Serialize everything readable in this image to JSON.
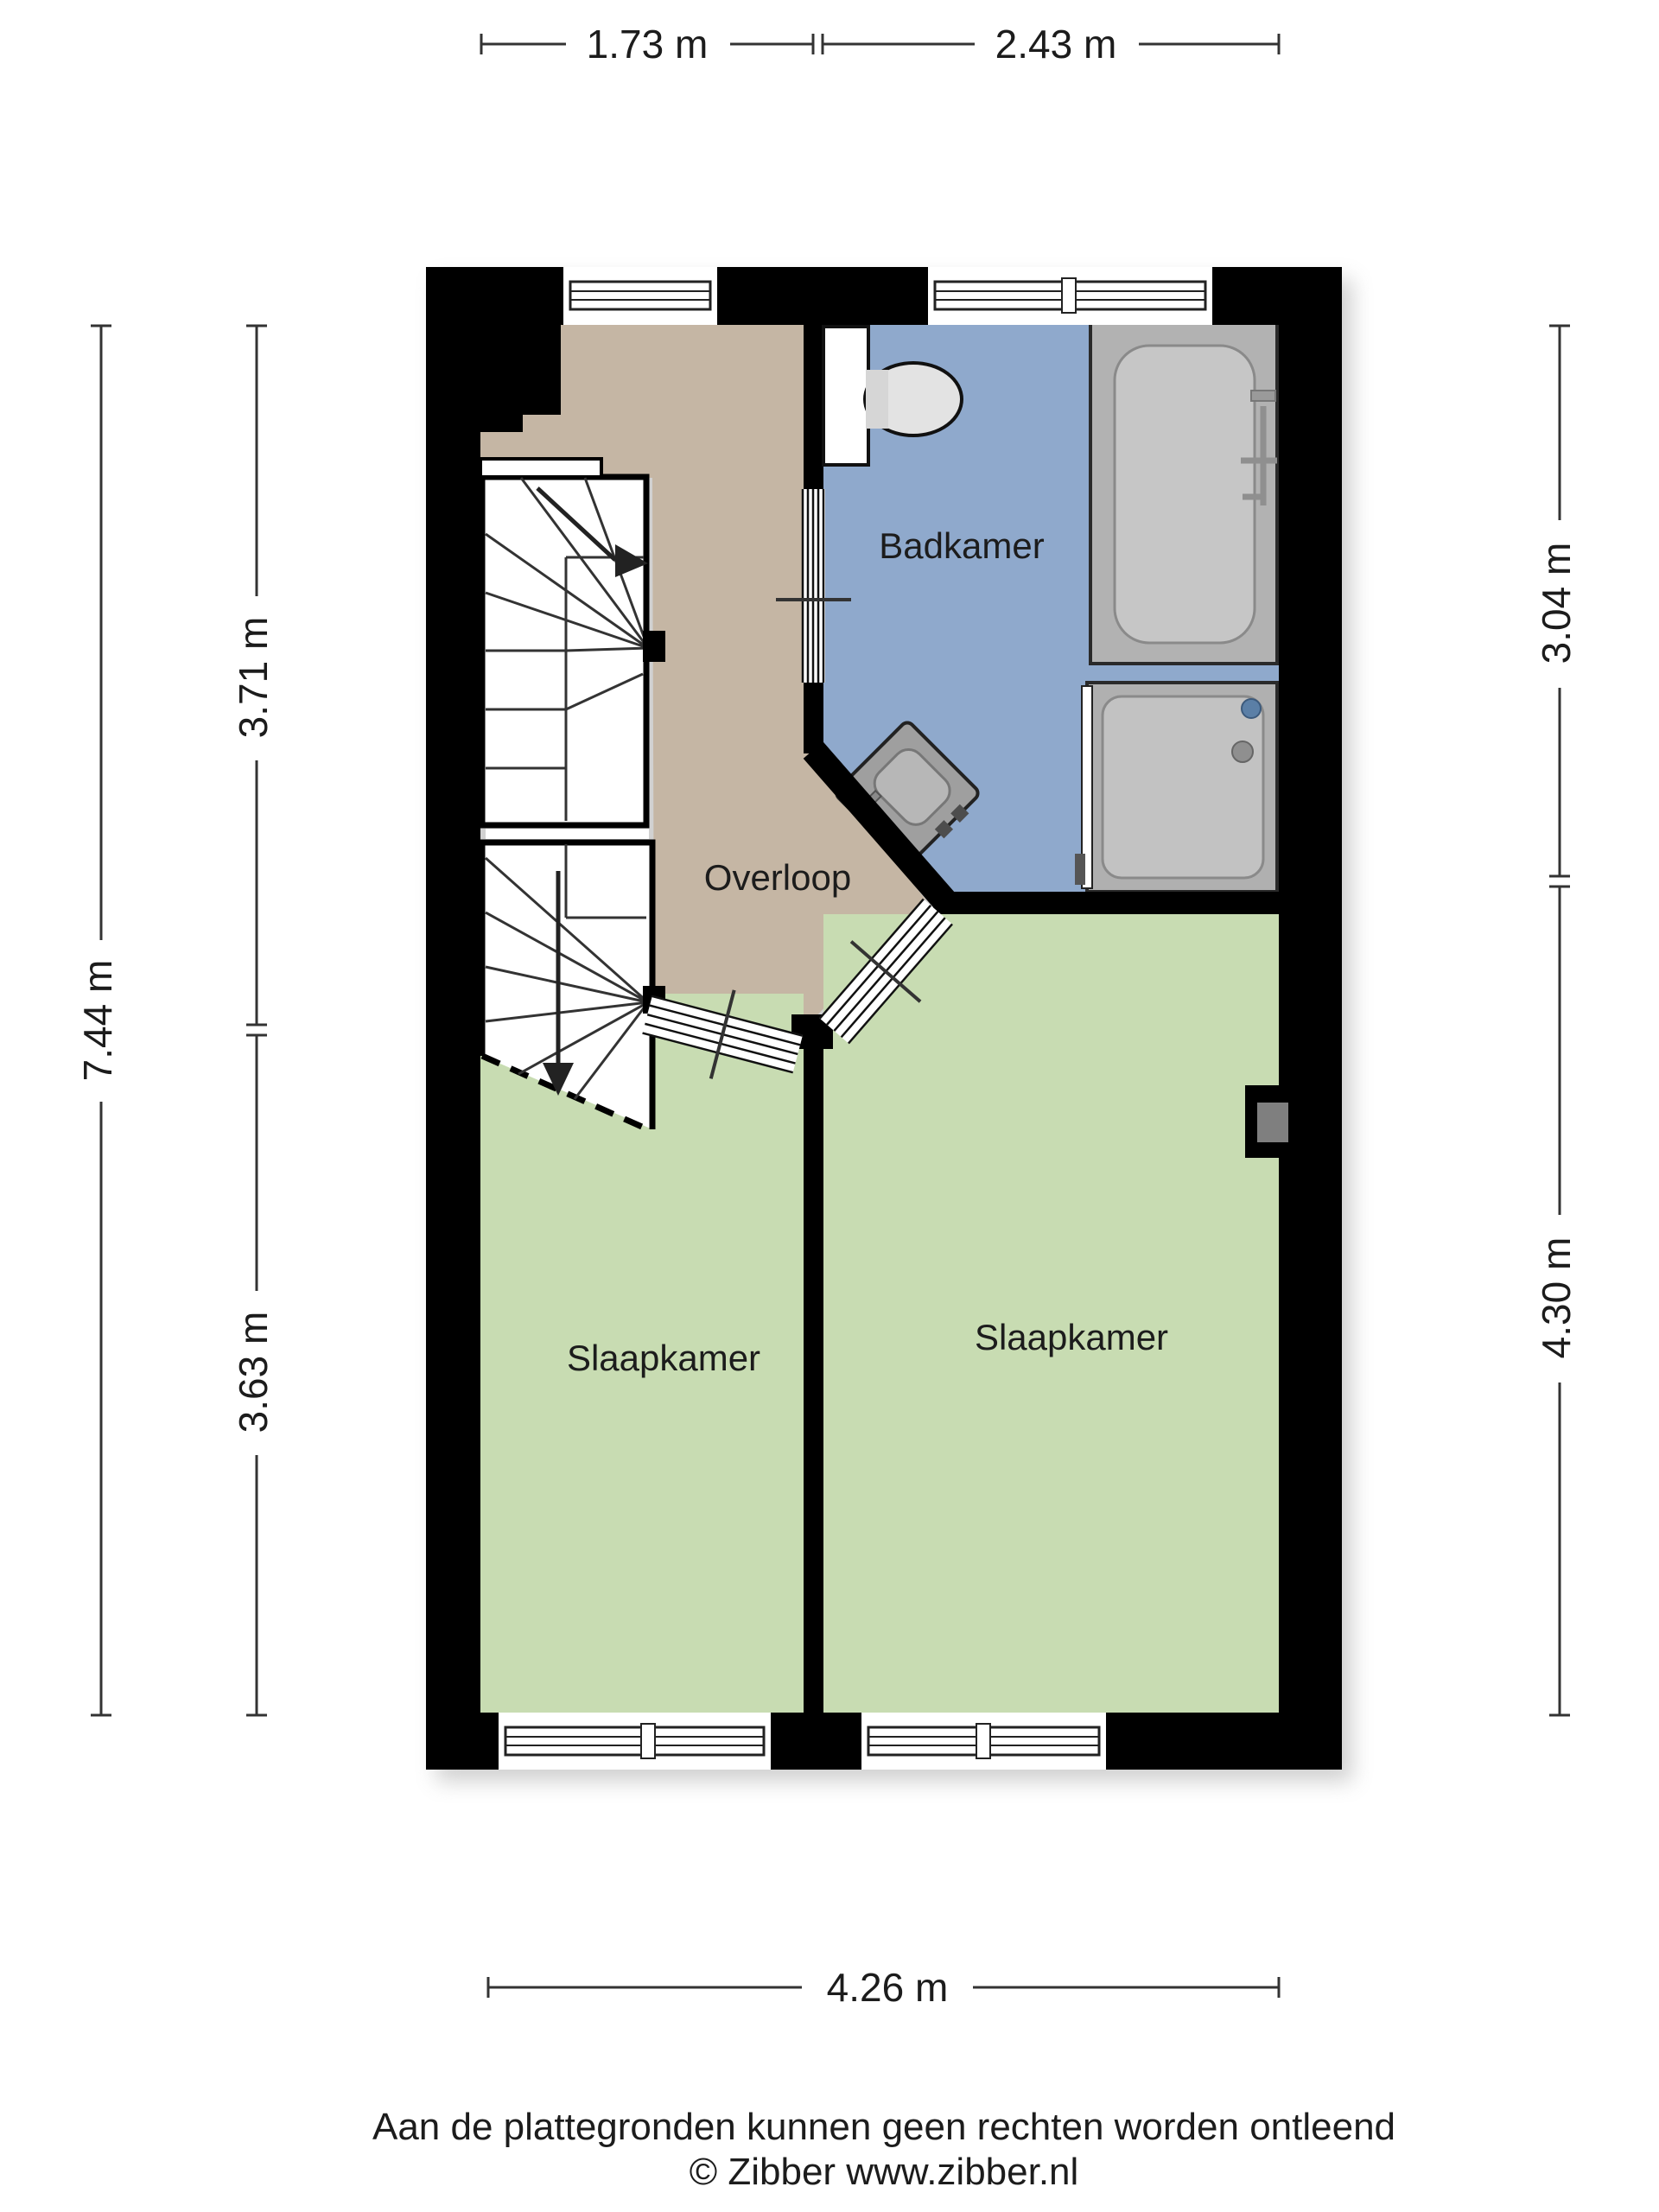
{
  "document": {
    "type": "floorplan",
    "floor": "verdieping",
    "background": "#ffffff"
  },
  "rooms": {
    "bathroom": {
      "label": "Badkamer"
    },
    "landing": {
      "label": "Overloop"
    },
    "bedroom_left": {
      "label": "Slaapkamer"
    },
    "bedroom_right": {
      "label": "Slaapkamer"
    }
  },
  "fixtures": {
    "bathtub": "bathtub",
    "shower": "shower",
    "washbasin": "washbasin",
    "toilet": "toilet",
    "stairs_up": "stairs-up",
    "stairs_down": "stairs-down"
  },
  "dimensions": {
    "top": [
      "1.73 m",
      "2.43 m"
    ],
    "left_outer": "7.44 m",
    "left_inner": [
      "3.71 m",
      "3.63 m"
    ],
    "right": [
      "3.04 m",
      "4.30 m"
    ],
    "bottom": "4.26 m"
  },
  "footer": {
    "disclaimer": "Aan de plattegronden kunnen geen rechten worden ontleend",
    "copyright": "© Zibber www.zibber.nl"
  },
  "colors": {
    "wall": "#000000",
    "bathroom_floor": "#8fa9cc",
    "landing_floor": "#c5b6a4",
    "bedroom_floor": "#c8dcb2",
    "fixture_gray": "#b2b2b2",
    "dim_line": "#333333"
  }
}
